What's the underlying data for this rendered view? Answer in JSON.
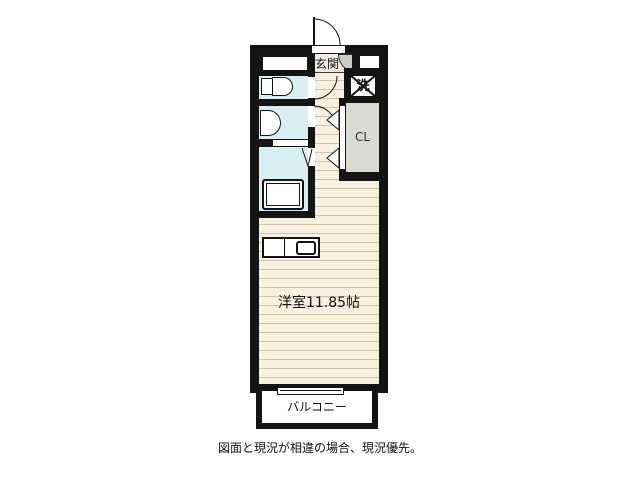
{
  "floorplan": {
    "labels": {
      "entrance": "玄関",
      "washer": "洗",
      "closet": "CL",
      "main_room": "洋室11.85帖",
      "balcony": "バルコニー"
    },
    "disclaimer": "図面と現況が相違の場合、現況優先。",
    "fixtures": [
      "entrance-door-swing",
      "toilet",
      "washbasin",
      "bathtub",
      "folding-bath-door",
      "washing-machine-pan",
      "closet-double-doors",
      "kitchen-counter",
      "kitchen-sink",
      "sliding-window"
    ],
    "colors": {
      "wall": "#141414",
      "floor": "#f8efdf",
      "floor_stripe": "#cfc2ab",
      "wet_area": "#d8edf4",
      "closet_gray": "#dbd9d3",
      "entrance_step_gray": "#cdcbc6",
      "background": "#ffffff",
      "text": "#141414"
    }
  }
}
